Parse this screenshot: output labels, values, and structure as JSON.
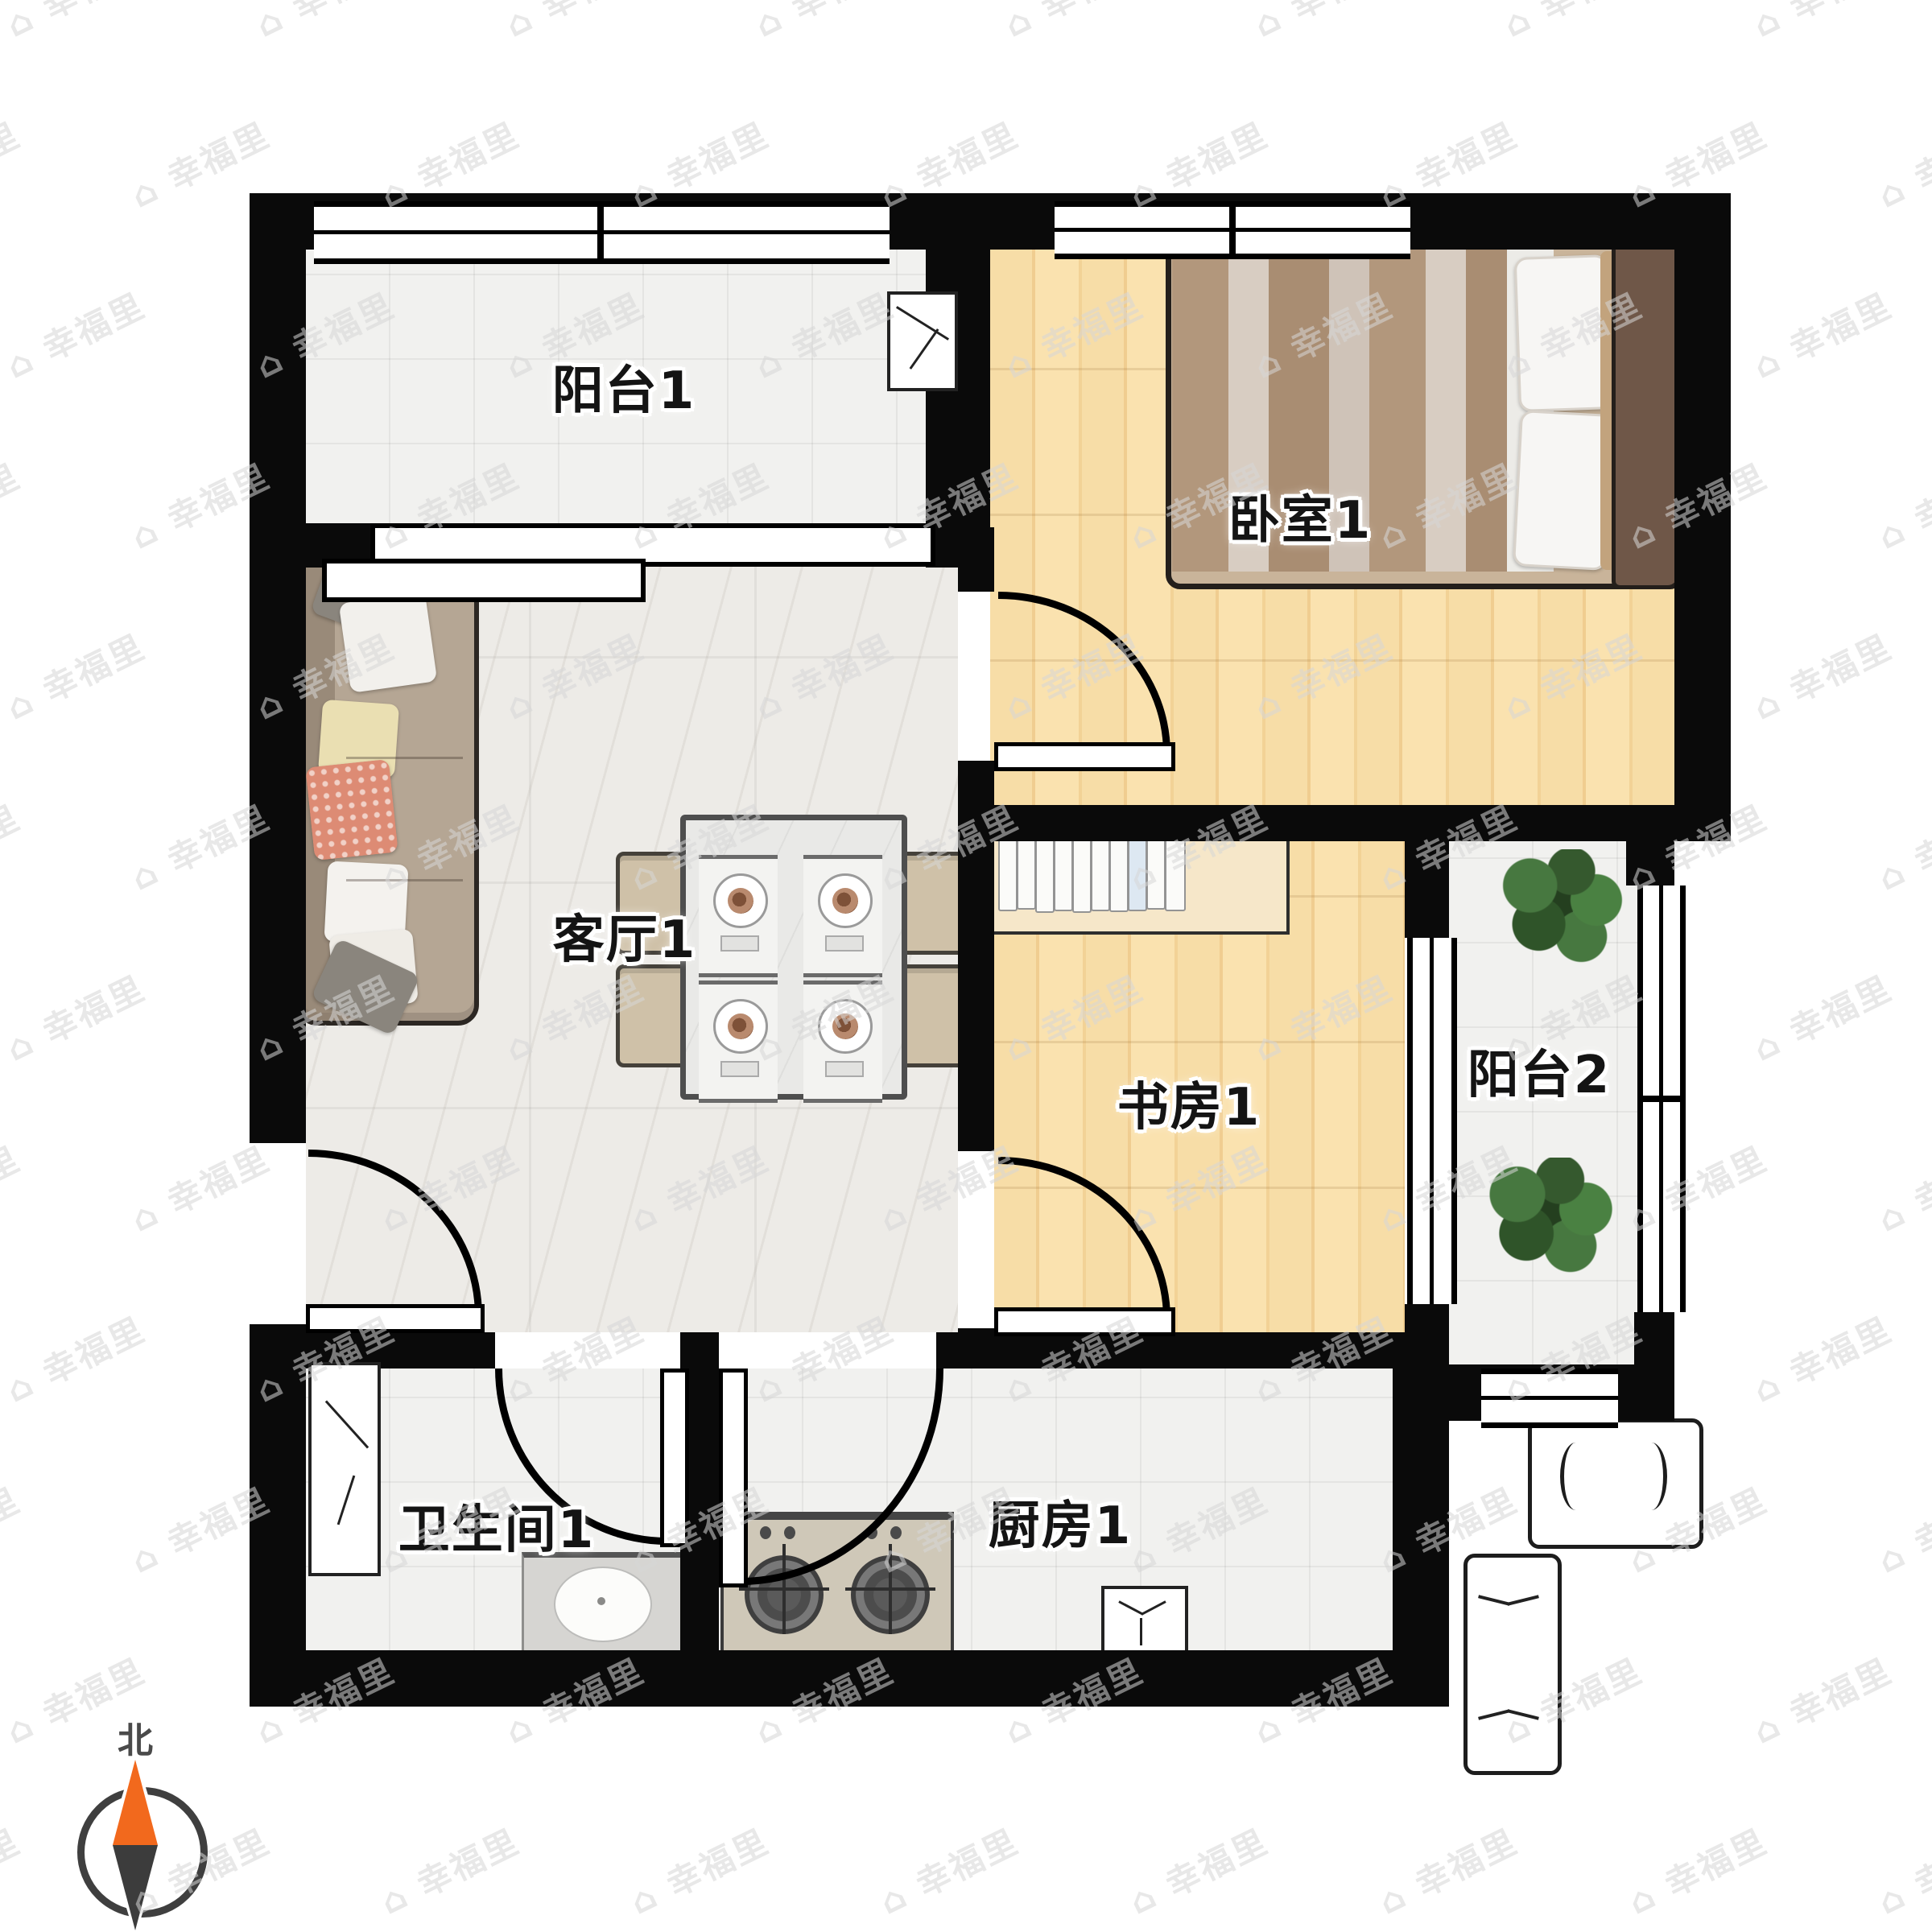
{
  "floor_plan": {
    "title": "apartment-floor-plan",
    "rooms": [
      {
        "id": "balcony-1",
        "label": "阳台1"
      },
      {
        "id": "bedroom-1",
        "label": "卧室1"
      },
      {
        "id": "living-room-1",
        "label": "客厅1"
      },
      {
        "id": "study-1",
        "label": "书房1"
      },
      {
        "id": "balcony-2",
        "label": "阳台2"
      },
      {
        "id": "bathroom-1",
        "label": "卫生间1"
      },
      {
        "id": "kitchen-1",
        "label": "厨房1"
      }
    ],
    "compass": {
      "north_label": "北",
      "needle_north_color": "#f2691d",
      "needle_south_color": "#3c3c3c"
    },
    "watermark": {
      "icon": "⌂",
      "text": "幸福里",
      "color": "#d7d7d7"
    },
    "colors": {
      "wall": "#0a0a0a",
      "wood_floor": "#f6d9a1",
      "tile_floor": "#f1f1ef",
      "marble_floor": "#edebe7",
      "sofa": "#b5a694",
      "coral_pillow": "#dd8b74",
      "bed_headboard": "#6f5748",
      "plant": "#3e6b34",
      "stove_counter": "#cfc8b8"
    }
  }
}
